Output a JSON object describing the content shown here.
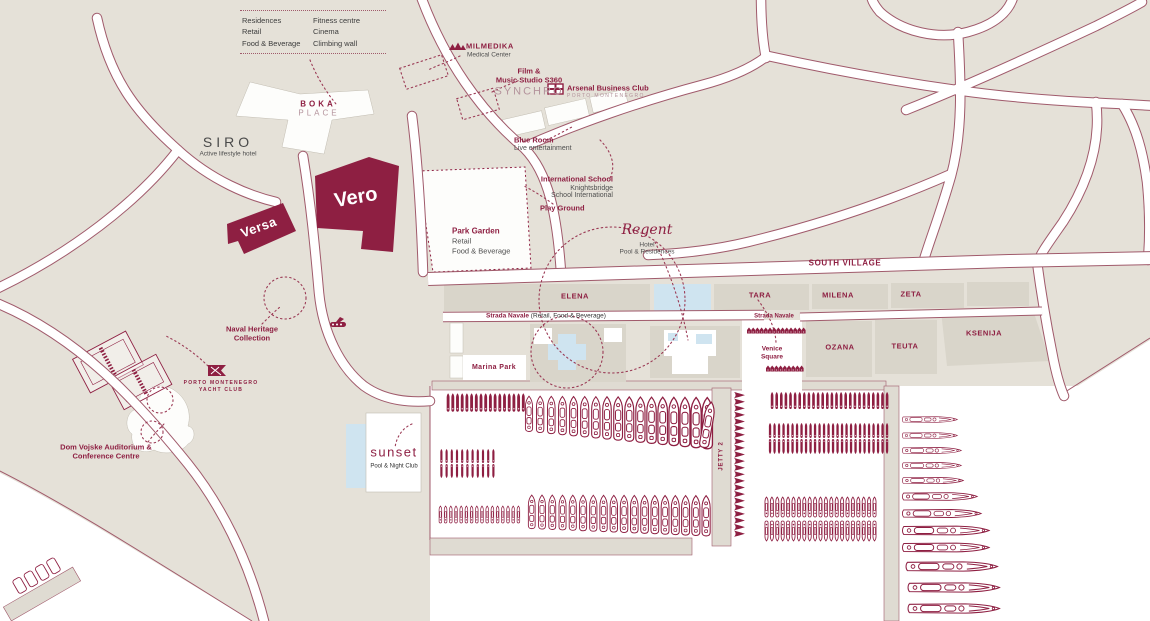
{
  "colors": {
    "land": "#e5e1d8",
    "water": "#ffffff",
    "block": "#d9d5ca",
    "quay": "#dfdbd2",
    "burgundy": "#8e1f42",
    "road_casing": "#a05a6b",
    "pool_blue": "#cfe4f0",
    "gray_text": "#4f4f4f",
    "muted_rose": "#b4939c"
  },
  "legend_box": {
    "col1": [
      "Residences",
      "Retail",
      "Food & Beverage"
    ],
    "col2": [
      "Fitness centre",
      "Cinema",
      "Climbing wall"
    ]
  },
  "pois": {
    "milmedika": {
      "name": "MILMEDIKA",
      "sub": "Medical Center"
    },
    "film_studio": {
      "l1": "Film &",
      "l2": "Music Studio S360",
      "logo": "SYNCHRO"
    },
    "arsenal": {
      "name": "Arsenal Business Club",
      "sub": "PORTO MONTENEGRO"
    },
    "blue_room": {
      "name": "Blue Room",
      "sub": "Live entertainment"
    },
    "intl_school": {
      "name": "International School",
      "sub1": "Knightsbridge",
      "sub2": "School International"
    },
    "play_ground": {
      "name": "Play Ground"
    },
    "boka": {
      "l1": "BOKA",
      "l2": "PLACE"
    },
    "siro": {
      "name": "SIRO",
      "sub": "Active lifestyle hotel"
    },
    "versa": {
      "name": "Versa"
    },
    "vero": {
      "name": "Vero"
    },
    "park_garden": {
      "name": "Park Garden",
      "sub1": "Retail",
      "sub2": "Food & Beverage"
    },
    "regent": {
      "name": "Regent",
      "sub1": "Hotel",
      "sub2": "Pool & Residences"
    },
    "naval_heritage": {
      "l1": "Naval Heritage",
      "l2": "Collection"
    },
    "yacht_club": {
      "l1": "PORTO MONTENEGRO",
      "l2": "YACHT CLUB"
    },
    "dom_vojske": {
      "l1": "Dom Vojske Auditorium &",
      "l2": "Conference Centre"
    },
    "sunset": {
      "name": "sunset",
      "sub": "Pool & Night Club"
    },
    "marina_park": {
      "name": "Marina Park"
    },
    "venice_square": {
      "l1": "Venice",
      "l2": "Square"
    },
    "jetty2": {
      "name": "JETTY 2"
    }
  },
  "streets": {
    "south_village": "SOUTH VILLAGE",
    "strada_navale_left": {
      "bold": "Strada Navale",
      "rest": " (Retail, Food & Beverage)"
    },
    "strada_navale_right": "Strada Navale",
    "blocks": [
      "ELENA",
      "TARA",
      "MILENA",
      "ZETA",
      "OZANA",
      "TEUTA",
      "KSENIJA"
    ]
  },
  "marina": {
    "rows": [
      {
        "name": "west-small-row",
        "type": "small",
        "x": 446,
        "y": 392,
        "count": 17,
        "dx": 4.7,
        "w": 4.2,
        "h": 21
      },
      {
        "name": "west-yacht-row",
        "type": "yacht-v",
        "x": 524,
        "y": 393,
        "count": 17,
        "dx": 11,
        "w": 10,
        "h": 42,
        "grow": 0.45
      },
      {
        "name": "west-small-duo-1",
        "type": "small",
        "x": 439,
        "y": 449,
        "count": 11,
        "dx": 5.2,
        "w": 4.8,
        "h": 14
      },
      {
        "name": "west-small-duo-2",
        "type": "small",
        "x": 439,
        "y": 464,
        "count": 11,
        "dx": 5.2,
        "w": 4.8,
        "h": 14,
        "flip": true
      },
      {
        "name": "west-small-outline-row",
        "type": "small-o",
        "x": 438,
        "y": 506,
        "count": 16,
        "dx": 5.2,
        "w": 4.8,
        "h": 17
      },
      {
        "name": "west-yacht-row-2",
        "type": "yacht-v",
        "x": 527,
        "y": 492,
        "count": 18,
        "dx": 10.2,
        "w": 9.5,
        "h": 40,
        "grow": 0.2
      },
      {
        "name": "jetty2-boats",
        "type": "chev",
        "x": 733,
        "y": 392,
        "count": 22,
        "dy": 6.6,
        "w": 13,
        "h": 6.2
      },
      {
        "name": "east-small-row-1",
        "type": "small",
        "x": 770,
        "y": 392,
        "count": 26,
        "dx": 4.6,
        "w": 4.2,
        "h": 17
      },
      {
        "name": "east-small-row-2",
        "type": "small",
        "x": 768,
        "y": 423,
        "count": 27,
        "dx": 4.5,
        "w": 4.1,
        "h": 15
      },
      {
        "name": "east-small-row-3",
        "type": "small",
        "x": 768,
        "y": 439,
        "count": 27,
        "dx": 4.5,
        "w": 4.1,
        "h": 15,
        "flip": true
      },
      {
        "name": "east-small-outline-row-1",
        "type": "small-o",
        "x": 764,
        "y": 497,
        "count": 21,
        "dx": 5.4,
        "w": 5,
        "h": 20
      },
      {
        "name": "east-small-outline-row-2",
        "type": "small-o",
        "x": 764,
        "y": 521,
        "count": 21,
        "dx": 5.4,
        "w": 5,
        "h": 20,
        "flip": true
      },
      {
        "name": "venice-stalls-top",
        "type": "stall",
        "x": 747,
        "y": 325,
        "count": 14,
        "dx": 4.2,
        "w": 4,
        "h": 11
      },
      {
        "name": "venice-stalls-bottom",
        "type": "stall",
        "x": 766,
        "y": 363,
        "count": 9,
        "dx": 4.2,
        "w": 4,
        "h": 11
      }
    ],
    "east_yachts": {
      "x": 902,
      "boats": [
        {
          "y": 413,
          "len": 56
        },
        {
          "y": 429,
          "len": 56
        },
        {
          "y": 444,
          "len": 60
        },
        {
          "y": 459,
          "len": 60
        },
        {
          "y": 474,
          "len": 62
        },
        {
          "y": 490,
          "len": 76
        },
        {
          "y": 507,
          "len": 80
        },
        {
          "y": 524,
          "len": 88
        },
        {
          "y": 541,
          "len": 88
        },
        {
          "y": 560,
          "len": 100
        },
        {
          "y": 581,
          "len": 104
        },
        {
          "y": 602,
          "len": 104
        }
      ]
    },
    "lone_yacht": {
      "x": 701,
      "y": 397,
      "w": 13,
      "h": 56,
      "rot": 10
    }
  }
}
